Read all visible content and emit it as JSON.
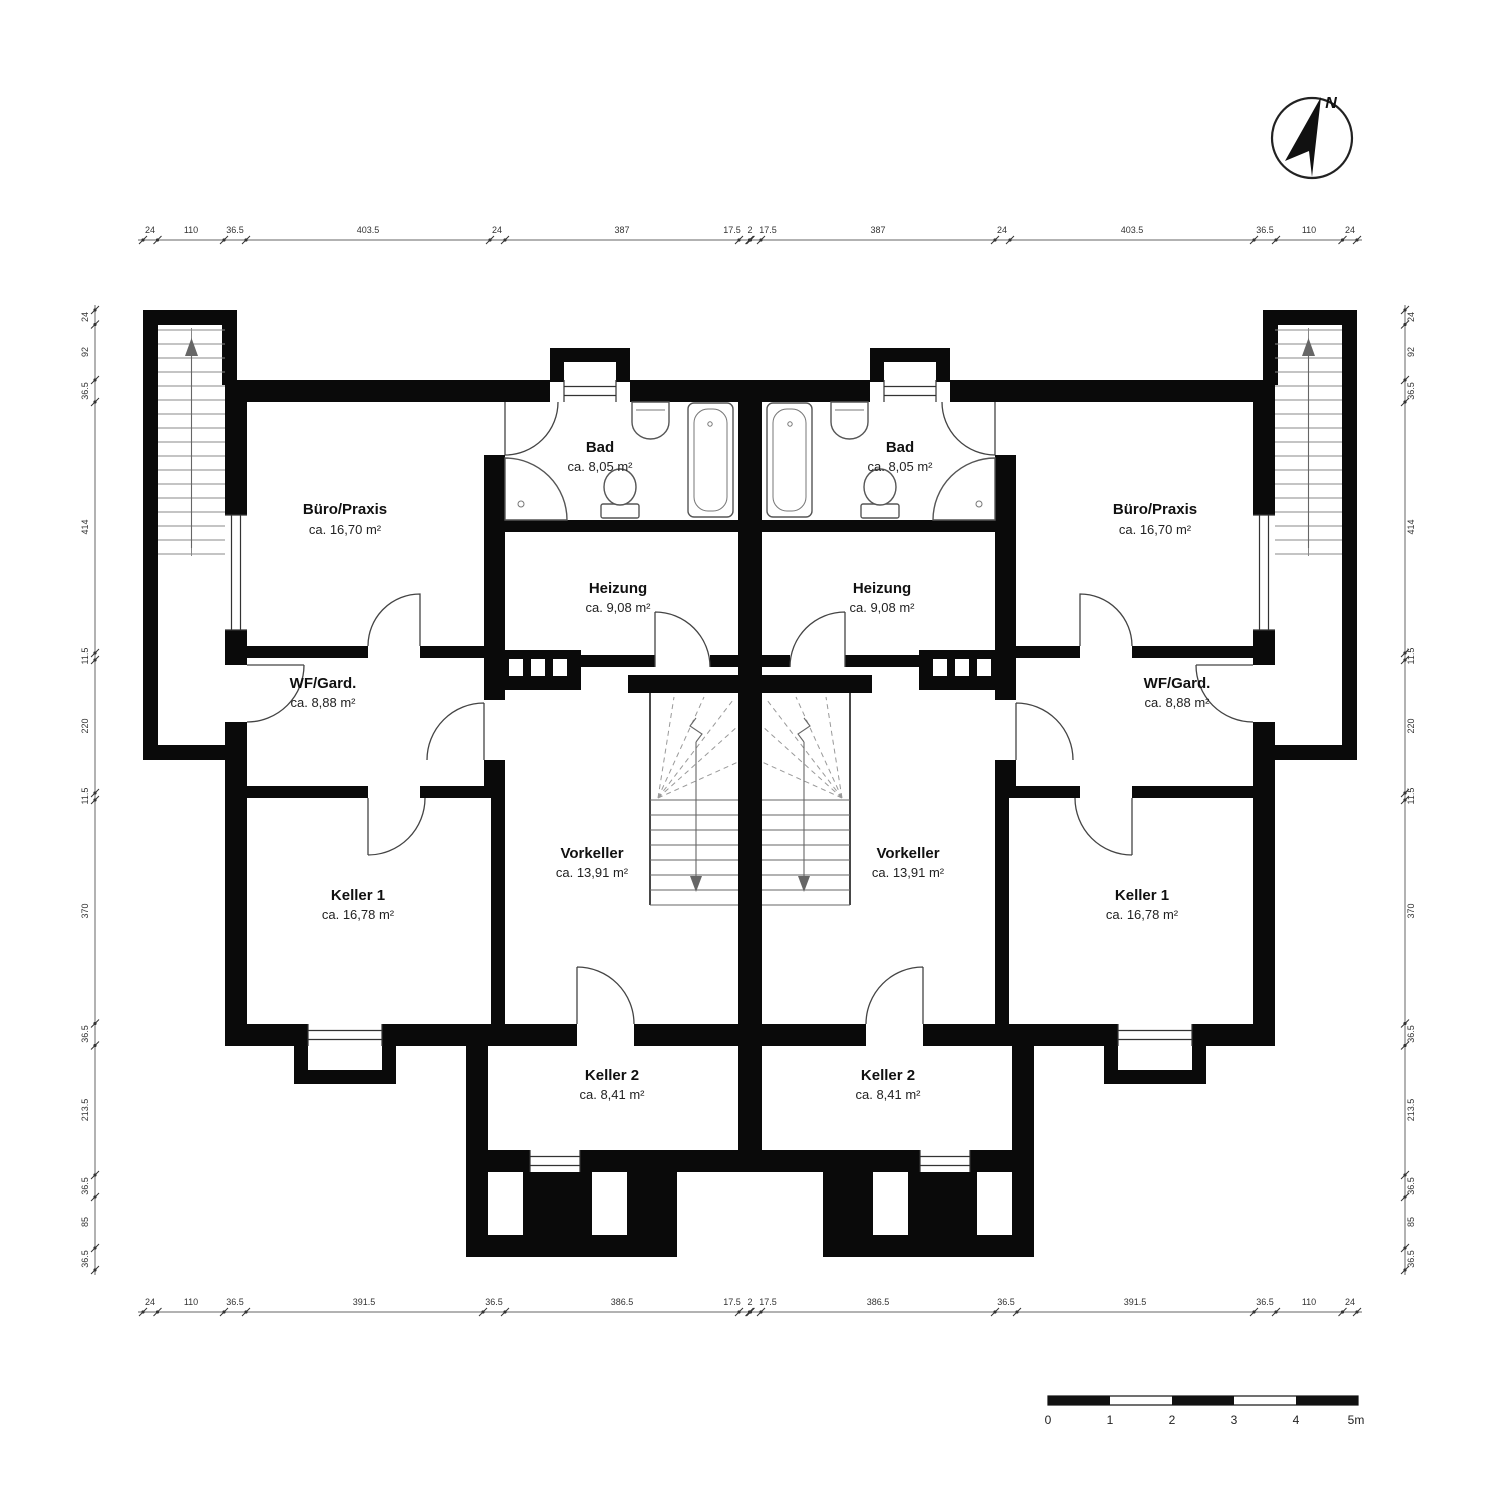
{
  "compass": {
    "label": "N"
  },
  "rooms": [
    {
      "name": "Büro/Praxis",
      "area": "ca. 16,70 m²"
    },
    {
      "name": "Bad",
      "area": "ca. 8,05 m²"
    },
    {
      "name": "Heizung",
      "area": "ca. 9,08 m²"
    },
    {
      "name": "WF/Gard.",
      "area": "ca. 8,88 m²"
    },
    {
      "name": "Keller 1",
      "area": "ca. 16,78 m²"
    },
    {
      "name": "Vorkeller",
      "area": "ca. 13,91 m²"
    },
    {
      "name": "Keller 2",
      "area": "ca. 8,41 m²"
    }
  ],
  "dimensions": {
    "top": [
      "24",
      "110",
      "36.5",
      "403.5",
      "24",
      "387",
      "17.5",
      "2",
      "17.5",
      "387",
      "24",
      "403.5",
      "36.5",
      "110",
      "24"
    ],
    "bottom": [
      "24",
      "110",
      "36.5",
      "391.5",
      "36.5",
      "386.5",
      "17.5",
      "2",
      "17.5",
      "386.5",
      "36.5",
      "391.5",
      "36.5",
      "110",
      "24"
    ],
    "left": [
      "24",
      "92",
      "36.5",
      "414",
      "11.5",
      "220",
      "11.5",
      "370",
      "36.5",
      "213.5",
      "36.5",
      "85",
      "36.5"
    ],
    "right": [
      "24",
      "92",
      "36.5",
      "414",
      "11.5",
      "220",
      "11.5",
      "370",
      "36.5",
      "213.5",
      "36.5",
      "85",
      "36.5"
    ]
  },
  "scale_bar": {
    "labels": [
      "0",
      "1",
      "2",
      "3",
      "4",
      "5m"
    ]
  }
}
